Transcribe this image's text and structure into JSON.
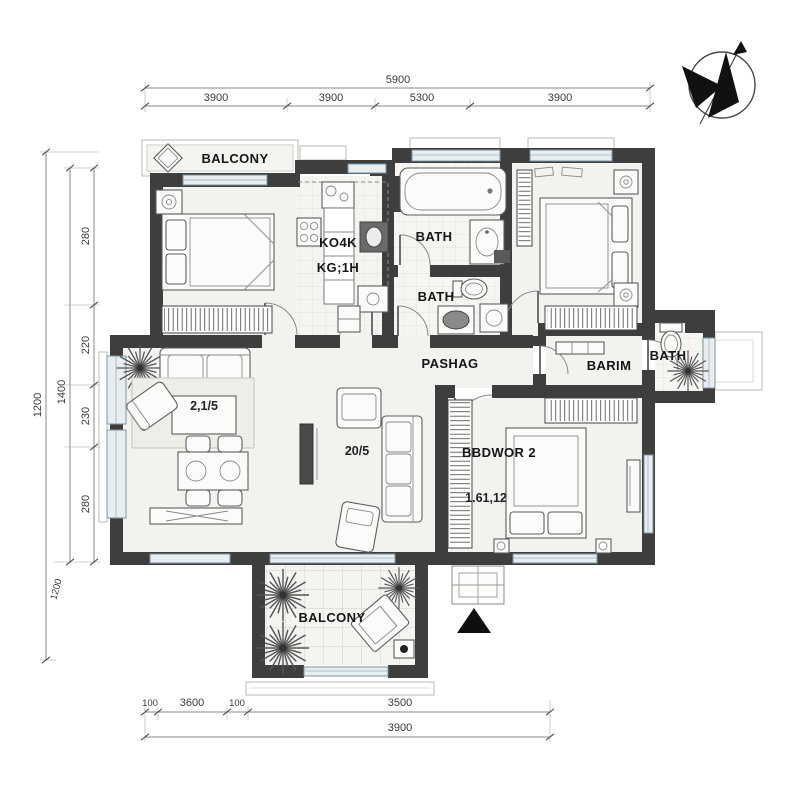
{
  "plan_title": "apartment-floor-plan",
  "dimensions": {
    "top": {
      "overall": "5900",
      "segments": [
        "3900",
        "3900",
        "5300",
        "3900"
      ]
    },
    "left": {
      "outer": "1200",
      "inner": "1400",
      "segments": [
        "280",
        "220",
        "230",
        "280"
      ],
      "bottom_small": "1200"
    },
    "bottom": {
      "overall": "3900",
      "segments": [
        "100",
        "3600",
        "100",
        "3500"
      ]
    }
  },
  "labels": {
    "balcony_top": "BALCONY",
    "kitchen_line1": "KO4K",
    "kitchen_line2": "KG;1H",
    "bath_top": "BATH",
    "bath_middle": "BATH",
    "bath_right": "BATH",
    "passage": "PASHAG",
    "hall": "BARIM",
    "bedroom2": "BBDWOR 2",
    "bedroom2_area": "1.61,12",
    "living_area": "2,1/5",
    "living_area2": "20/5",
    "balcony_bottom": "BALCONY"
  },
  "colors": {
    "wall": "#3e3e3e",
    "floor": "#f2f2ef",
    "window": "#e7edf0",
    "marker": "#111111"
  }
}
